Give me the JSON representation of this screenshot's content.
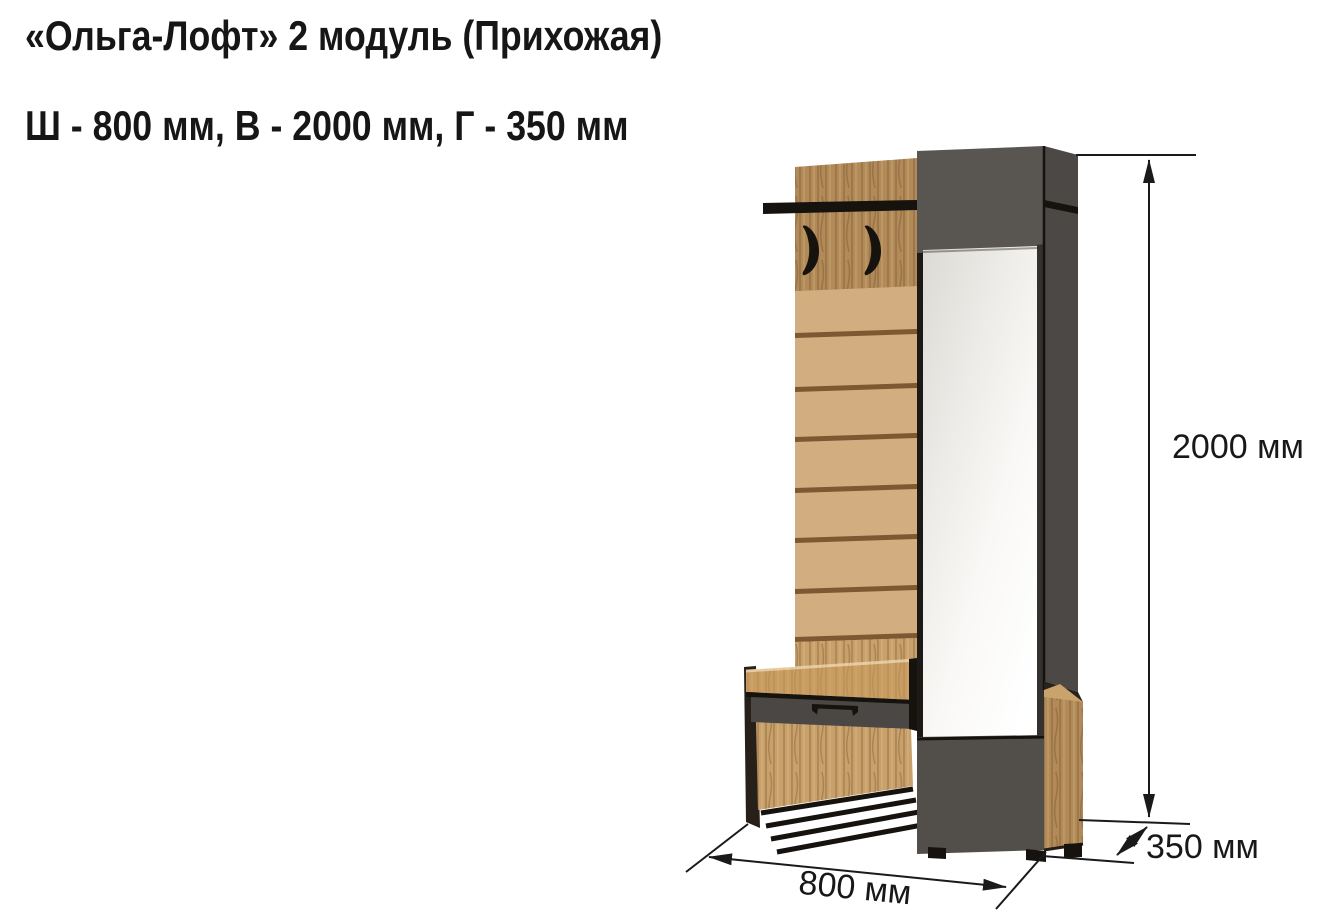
{
  "header": {
    "title": "«Ольга-Лофт» 2 модуль (Прихожая)",
    "dimensions_line": "Ш - 800 мм, В - 2000 мм, Г - 350 мм"
  },
  "figure": {
    "dimension_labels": {
      "height": "2000 мм",
      "width": "800 мм",
      "depth": "350 мм"
    }
  },
  "colors": {
    "background": "#ffffff",
    "text": "#161616",
    "dimension_line": "#1a1a1a",
    "oak": "#b28a58",
    "oak_light": "#c8a06a",
    "slat_tan": "#d2ad7f",
    "slat_gap": "#7c5833",
    "bench_oak": "#c99d62",
    "gray_front": "#595551",
    "gray_side": "#4c4845",
    "drawer_gray": "#4b4744",
    "black_trim": "#16120e",
    "mirror": "#f2f1ee"
  }
}
